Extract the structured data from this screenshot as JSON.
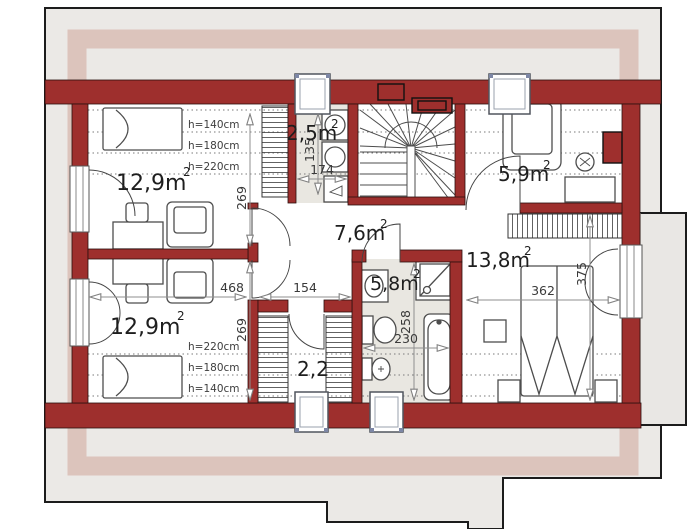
{
  "title": "attic-floor-plan",
  "colors": {
    "wall": "#9e2f2d",
    "roof_gray": "#ebe9e6",
    "roof_pink": "#dcc4bc",
    "tile": "#e9e7e1",
    "balcony": "#e9e7e4",
    "furniture_line": "#4d4d4d"
  },
  "rooms": [
    {
      "id": "room-top-left",
      "label": "12,9m",
      "sup": "2"
    },
    {
      "id": "laundry",
      "label": "2,5m",
      "sup": "2"
    },
    {
      "id": "room-top-right",
      "label": "5,9m",
      "sup": "2"
    },
    {
      "id": "hall",
      "label": "7,6m",
      "sup": "2"
    },
    {
      "id": "bathroom",
      "label": "5,8m",
      "sup": "2"
    },
    {
      "id": "bedroom",
      "label": "13,8m",
      "sup": "2"
    },
    {
      "id": "room-bottom-left",
      "label": "12,9m",
      "sup": "2"
    },
    {
      "id": "closet",
      "label": "2,2",
      "sup": ""
    }
  ],
  "dims": {
    "room_tl_depth": "269",
    "room_bl_depth": "269",
    "rooms_width": "468",
    "hall_width": "154",
    "laundry_width": "174",
    "laundry_depth": "135",
    "bath_depth": "258",
    "bath_width": "230",
    "bedroom_width": "362",
    "bedroom_depth": "375"
  },
  "height_labels_top": [
    "h=140cm",
    "h=180cm",
    "h=220cm"
  ],
  "height_labels_bottom": [
    "h=220cm",
    "h=180cm",
    "h=140cm"
  ]
}
